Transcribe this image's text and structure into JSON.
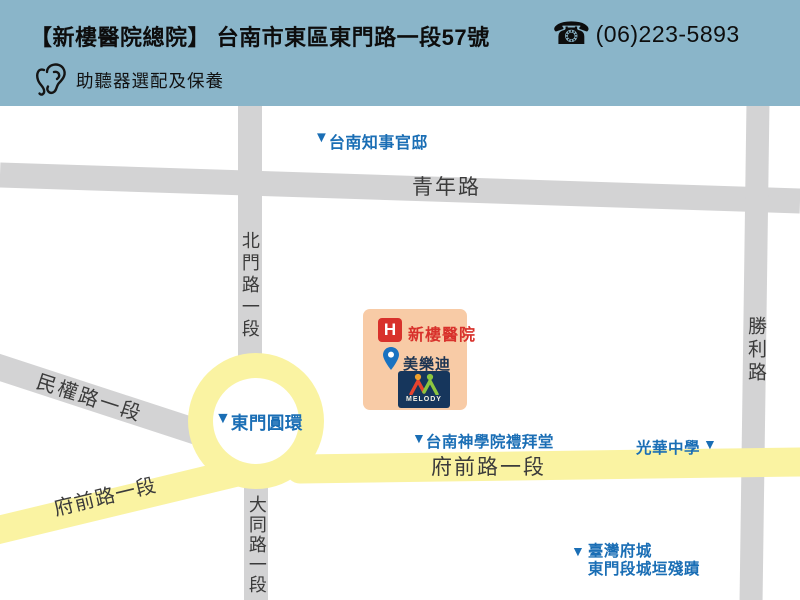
{
  "marker_glyph": "▼",
  "header": {
    "title": "【新樓醫院總院】 台南市東區東門路一段57號",
    "phone_icon_glyph": "☎",
    "phone": "(06)223-5893",
    "service": "助聽器選配及保養"
  },
  "map": {
    "roads": {
      "qingnian": "青年路",
      "beimen": "北門路一段",
      "shengli": "勝利路",
      "minquan": "民權路一段",
      "datong": "大同路一段",
      "fuqian_east": "府前路一段",
      "fuqian_sw": "府前路一段"
    },
    "roundabout": "東門圓環",
    "landmarks": {
      "official_residence": "台南知事官邸",
      "seminary": "台南神學院禮拜堂",
      "guanghua_school": "光華中學",
      "city_wall_line1": "臺灣府城",
      "city_wall_line2": "東門段城垣殘蹟"
    },
    "hospital_block": {
      "h_badge": "H",
      "hospital_name": "新樓醫院",
      "store_name": "美樂迪",
      "logo_text": "MELODY"
    },
    "colors": {
      "header_bg": "#8ab5c9",
      "road_gray": "#d3d3d4",
      "road_yellow": "#faf3a2",
      "landmark_blue": "#1a6eb5",
      "road_label_dark": "#3b3b3b",
      "hospital_red": "#d8312b",
      "hospital_block_bg": "#f8cba6",
      "melody_navy": "#16365c",
      "pin_blue": "#1a72c0"
    }
  }
}
